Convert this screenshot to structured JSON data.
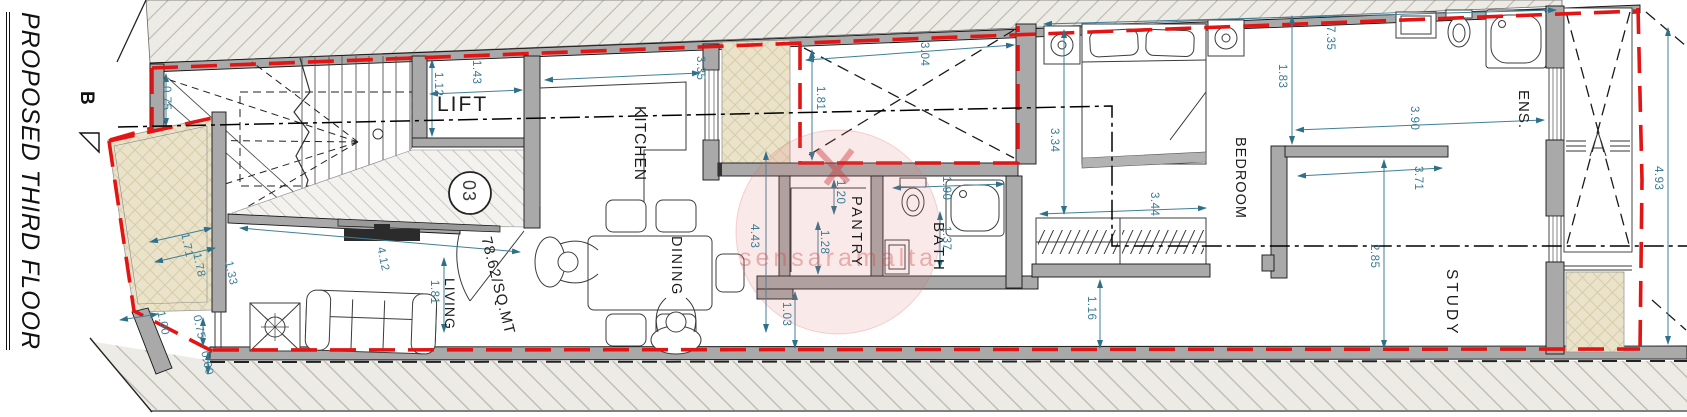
{
  "title": "PROPOSED THIRD FLOOR",
  "section_marker": {
    "label": "B"
  },
  "unit_circle": {
    "number": "03"
  },
  "watermark": "sensaramalta",
  "colors": {
    "boundary_red": "#e21414",
    "dimension_teal": "#3a7c95",
    "wall_grey": "#a9a9a9",
    "terrace_beige": "#eae3ca"
  },
  "room_labels": [
    {
      "id": "lift",
      "label": "LIFT",
      "x": 437,
      "y": 93,
      "rot": 0,
      "size": 21,
      "ls": 2
    },
    {
      "id": "kitchen",
      "label": "KITCHEN",
      "x": 648,
      "y": 106,
      "rot": 90,
      "size": 15.5,
      "ls": 1
    },
    {
      "id": "dining",
      "label": "DINING",
      "x": 684,
      "y": 236,
      "rot": 90,
      "size": 14.5,
      "ls": 1.5
    },
    {
      "id": "living",
      "label": "LIVING",
      "x": 458,
      "y": 278,
      "rot": 90,
      "size": 14,
      "ls": 1
    },
    {
      "id": "pantry",
      "label": "PANTRY",
      "x": 864,
      "y": 196,
      "rot": 90,
      "size": 14.5,
      "ls": 2.5
    },
    {
      "id": "bath",
      "label": "BATH",
      "x": 947,
      "y": 222,
      "rot": 90,
      "size": 15,
      "ls": 3
    },
    {
      "id": "bedroom",
      "label": "BEDROOM",
      "x": 1248,
      "y": 137,
      "rot": 90,
      "size": 14.5,
      "ls": 1
    },
    {
      "id": "ens",
      "label": "ENS.",
      "x": 1532,
      "y": 90,
      "rot": 90,
      "size": 15,
      "ls": 1
    },
    {
      "id": "study",
      "label": "STUDY",
      "x": 1460,
      "y": 269,
      "rot": 90,
      "size": 15.5,
      "ls": 3
    },
    {
      "id": "area",
      "label": "78.62/SQ.MT",
      "x": 494,
      "y": 235,
      "rot": 76,
      "size": 15,
      "ls": 1
    }
  ],
  "dimensions": [
    {
      "v": "0.75",
      "x": 172,
      "y": 86
    },
    {
      "v": "1.12",
      "x": 444,
      "y": 72
    },
    {
      "v": "1.43",
      "x": 482,
      "y": 60
    },
    {
      "v": "3.35",
      "x": 706,
      "y": 56
    },
    {
      "v": "3.04",
      "x": 930,
      "y": 42
    },
    {
      "v": "1.81",
      "x": 826,
      "y": 86
    },
    {
      "v": "4.43",
      "x": 760,
      "y": 224
    },
    {
      "v": "1.20",
      "x": 846,
      "y": 180
    },
    {
      "v": "1.28",
      "x": 830,
      "y": 230
    },
    {
      "v": "1.03",
      "x": 792,
      "y": 302
    },
    {
      "v": "1.90",
      "x": 952,
      "y": 176
    },
    {
      "v": "1.37",
      "x": 952,
      "y": 226
    },
    {
      "v": "3.44",
      "x": 1160,
      "y": 192
    },
    {
      "v": "1.16",
      "x": 1097,
      "y": 296
    },
    {
      "v": "3.34",
      "x": 1060,
      "y": 128
    },
    {
      "v": "1.83",
      "x": 1288,
      "y": 64
    },
    {
      "v": "7.35",
      "x": 1336,
      "y": 26
    },
    {
      "v": "3.90",
      "x": 1420,
      "y": 106
    },
    {
      "v": "3.71",
      "x": 1424,
      "y": 166
    },
    {
      "v": "2.85",
      "x": 1380,
      "y": 244
    },
    {
      "v": "4.93",
      "x": 1664,
      "y": 166
    },
    {
      "v": "1.81",
      "x": 440,
      "y": 280
    },
    {
      "v": "4.12",
      "x": 386,
      "y": 246,
      "rot": 78
    },
    {
      "v": "1.71",
      "x": 190,
      "y": 232,
      "rot": 78
    },
    {
      "v": "1.78",
      "x": 202,
      "y": 252,
      "rot": 78
    },
    {
      "v": "1.33",
      "x": 234,
      "y": 260,
      "rot": 78
    },
    {
      "v": "1.00",
      "x": 166,
      "y": 310,
      "rot": 78
    },
    {
      "v": "0.75",
      "x": 202,
      "y": 314,
      "rot": 78
    },
    {
      "v": "0.60",
      "x": 210,
      "y": 350,
      "rot": 78
    }
  ]
}
